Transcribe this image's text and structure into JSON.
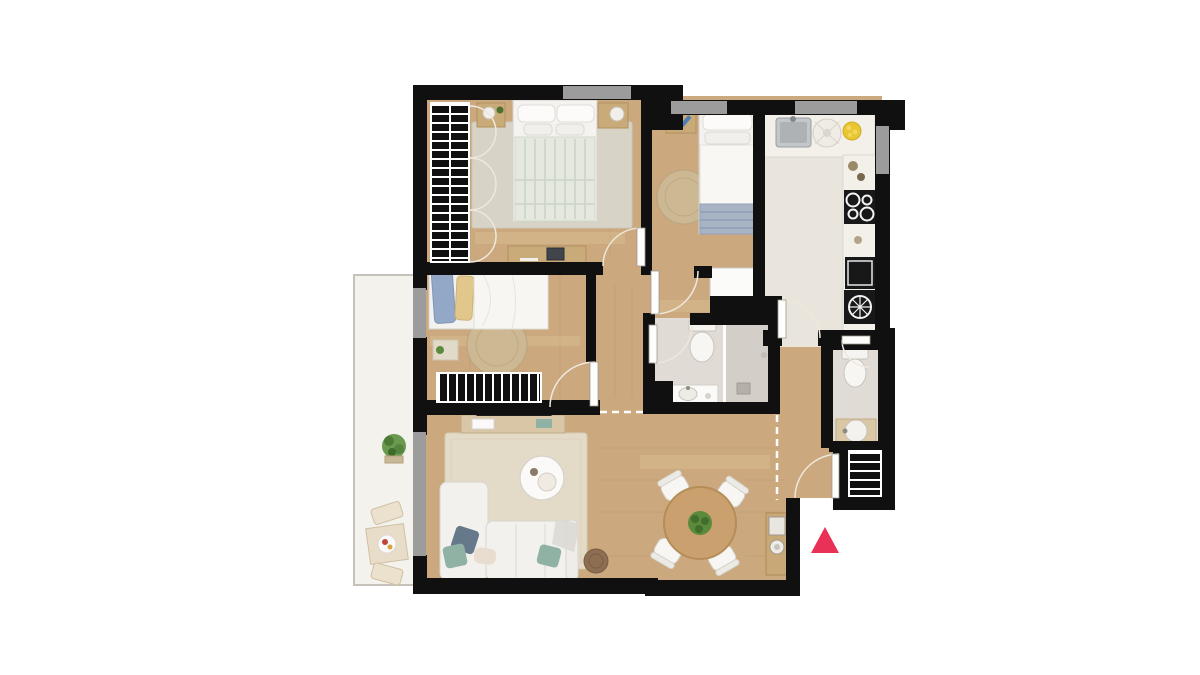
{
  "canvas": {
    "width": 1200,
    "height": 675,
    "background": "#ffffff"
  },
  "colors": {
    "wall": "#101010",
    "wood_floor": "#cba87e",
    "tile_floor": "#e9e5dd",
    "bath_floor": "#e0dcd5",
    "shower_floor": "#d3cfc8",
    "balcony_floor": "#f4f2ed",
    "window_gray": "#9c9c9c",
    "rug_bedroom": "#d8d3c7",
    "rug_living": "#e3dbc8",
    "rug_round": "#ccb893",
    "duvet_sage": "#e4e8de",
    "blanket_blue": "#a8b3c6",
    "pillow_blue": "#92a8c6",
    "pillow_yellow": "#e1c78c",
    "cushion_teal": "#8fb2a4",
    "cushion_slate": "#66798b",
    "appliance_black": "#181818",
    "steel_gray": "#c4c7c9",
    "lemon_yellow": "#e9c531",
    "plant_green": "#5b8a3c",
    "table_wood": "#c9a06e",
    "wood_furniture": "#c9aa79",
    "pouf_brown": "#8d6e52",
    "accent": "#e93057",
    "arc_line": "#efe8dc",
    "white_furniture": "#f3f1ee"
  },
  "plan": {
    "type": "apartment-floor-plan-top-view",
    "rooms": [
      {
        "id": "bedroom-main",
        "furniture": [
          "double-bed",
          "nightstand-left",
          "nightstand-right",
          "hatched-wardrobe",
          "desk-with-laptop",
          "area-rug",
          "window"
        ]
      },
      {
        "id": "bedroom-single",
        "furniture": [
          "single-bed",
          "nightstand",
          "round-jute-rug",
          "white-closet",
          "window"
        ]
      },
      {
        "id": "kitchen",
        "furniture": [
          "steel-sink",
          "round-hob",
          "fruit-plate",
          "counter-run",
          "cooktop-4-burners",
          "oven",
          "washing-machine",
          "window"
        ]
      },
      {
        "id": "bedroom-second",
        "furniture": [
          "bed-blue-yellow-pillows",
          "nightstand",
          "round-jute-rug",
          "hatched-wardrobe",
          "balcony-window"
        ]
      },
      {
        "id": "bathroom",
        "furniture": [
          "toilet",
          "walk-in-shower",
          "glass-partition",
          "vanity-sink"
        ]
      },
      {
        "id": "wc",
        "furniture": [
          "toilet",
          "round-basin-on-counter"
        ]
      },
      {
        "id": "living-room",
        "furniture": [
          "corner-sofa",
          "throw-pillows",
          "coffee-table",
          "tv",
          "tv-console",
          "area-rug",
          "pouf",
          "balcony-door"
        ]
      },
      {
        "id": "dining-area",
        "furniture": [
          "round-table",
          "four-chairs",
          "plant-centerpiece",
          "entry-console"
        ]
      },
      {
        "id": "hallway",
        "furniture": [
          "hatched-entry-closet",
          "dashed-threshold-lines"
        ]
      },
      {
        "id": "balcony",
        "furniture": [
          "plant",
          "bistro-table",
          "two-chairs"
        ]
      }
    ],
    "markers": {
      "entrance": {
        "symbol": "triangle-up",
        "color_ref": "accent",
        "position": "bottom-right-outside"
      }
    },
    "windows_count": 6,
    "door_swings_count": 7
  }
}
